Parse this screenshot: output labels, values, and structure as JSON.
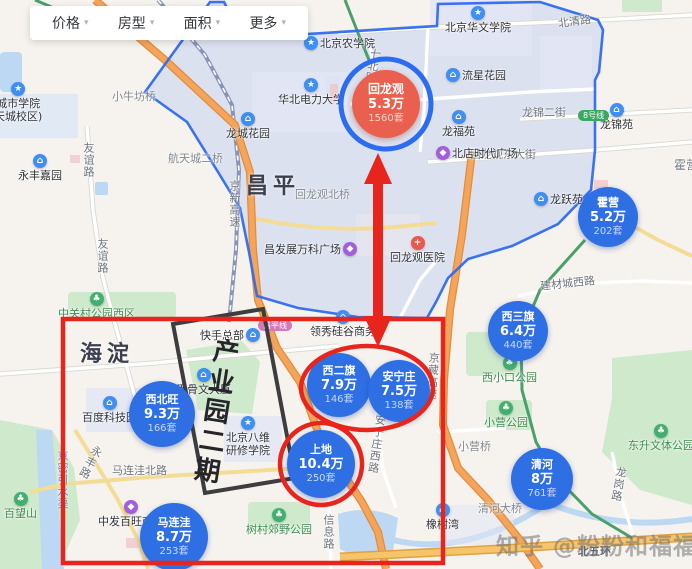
{
  "filter_bar": {
    "items": [
      "价格",
      "房型",
      "面积",
      "更多"
    ]
  },
  "icons": {
    "chevron_down": "▾",
    "residential": "⌂",
    "school": "★",
    "park": "♣",
    "mall": "◆",
    "hospital": "+",
    "business": "⌂"
  },
  "districts": {
    "changping": "昌平",
    "haidian": "海淀"
  },
  "region_highlight": {
    "name": "回龙观",
    "border_color": "#2f6af0"
  },
  "bubbles": [
    {
      "name": "回龙观",
      "price": "5.3万",
      "count": "1560套",
      "color": "#e9604e"
    },
    {
      "name": "霍营",
      "price": "5.2万",
      "count": "202套",
      "color": "#2f6fe4"
    },
    {
      "name": "西三旗",
      "price": "6.4万",
      "count": "440套",
      "color": "#2f6fe4"
    },
    {
      "name": "西二旗",
      "price": "7.9万",
      "count": "146套",
      "color": "#2f6fe4"
    },
    {
      "name": "安宁庄",
      "price": "7.5万",
      "count": "138套",
      "color": "#2f6fe4"
    },
    {
      "name": "上地",
      "price": "10.4万",
      "count": "250套",
      "color": "#2f6fe4"
    },
    {
      "name": "西北旺",
      "price": "9.3万",
      "count": "166套",
      "color": "#2f6fe4"
    },
    {
      "name": "马连洼",
      "price": "8.7万",
      "count": "253套",
      "color": "#2f6fe4"
    },
    {
      "name": "清河",
      "price": "8万",
      "count": "761套",
      "color": "#2f6fe4"
    }
  ],
  "annotations": {
    "zone_label": "产业园二期",
    "annotation_red": "#e8251c",
    "highlight_ring_blue": "#2b6cf0"
  },
  "labels": {
    "roads": {
      "beiqinglu": "北清路",
      "youyilu": "友谊路",
      "huilongguan_dongdajie": "回龙观东大街",
      "longjin_erjie": "龙锦二街",
      "jiancai_chengxilu": "建材城西路",
      "malianwa_beilu": "马连洼北路",
      "xinxilu": "信息路",
      "anningzhuang_xilu": "安宁庄西路",
      "jingzang_gaosu": "京藏高速",
      "jingxin_gaosu": "京新高速",
      "beiwuhuan": "北五环",
      "yongfenglu": "永丰路",
      "qibeilu": "七北路",
      "longganglu": "龙岗路"
    },
    "bridges": {
      "huilongguan_beiqiao": "回龙观北桥",
      "hangtiancheng_erqiao": "航天城二桥",
      "xiaoniufang_qiao": "小牛坊桥",
      "xiaoying_qiao": "小营桥",
      "qinghe_daqiao": "清河大桥"
    },
    "residential": {
      "yongfeng_jiayuan": "永丰嘉园",
      "longcheng_huayuan": "龙城花园",
      "liuxing_huayuan": "流星花园",
      "longfu_yuan": "龙福苑",
      "longjin_yuan": "龙锦苑",
      "longyue_yuan": "龙跃苑",
      "xiangshuwan": "橡树湾"
    },
    "schools": {
      "beijing_nongxueyuan": "北京农学院",
      "beijing_huawen_xueyuan": "北京华文学院",
      "huabei_dianli_daxue": "华北电力大学",
      "chengshi_xueyuan_line1": "城市学院",
      "chengshi_xueyuan_line2": "天城校区)",
      "bawei_line1": "北京八维",
      "bawei_line2": "研修学院"
    },
    "parks": {
      "zhongguancun_gongyuan_xiqu": "中关村公园西区",
      "xixiaokou_gongyuan": "西小口公园",
      "xiaoying_gongyuan": "小营公园",
      "dongsheng_wenti_gongyuan": "东升文体公园",
      "shucun_jiaoye_gongyuan": "树村郊野公园",
      "baiwangshan": "百望山"
    },
    "malls": {
      "beidian_shidai_guangchang": "北店时代广场",
      "changfazhan_wanke_guangchang": "昌发展万科广场",
      "zhongfa_baiwang": "中发百旺商城"
    },
    "hospital": {
      "huilongguan_yiyuan": "回龙观医院"
    },
    "business": {
      "kuaishou_zongbu": "快手总部",
      "jiaguwen_dasha": "甲骨文大厦",
      "baidu_kejiyuan": "百度科技园",
      "lingxiu_guigu": "领秀硅谷商务"
    },
    "transit": {
      "changping_line": "昌平线",
      "line_8": "8号线"
    },
    "areas": {
      "huoying": "霍营"
    },
    "water": {
      "jingmi_yinshuiqu": "京密引水渠"
    }
  },
  "watermark": {
    "text": "知乎 @粉粉和福福"
  }
}
